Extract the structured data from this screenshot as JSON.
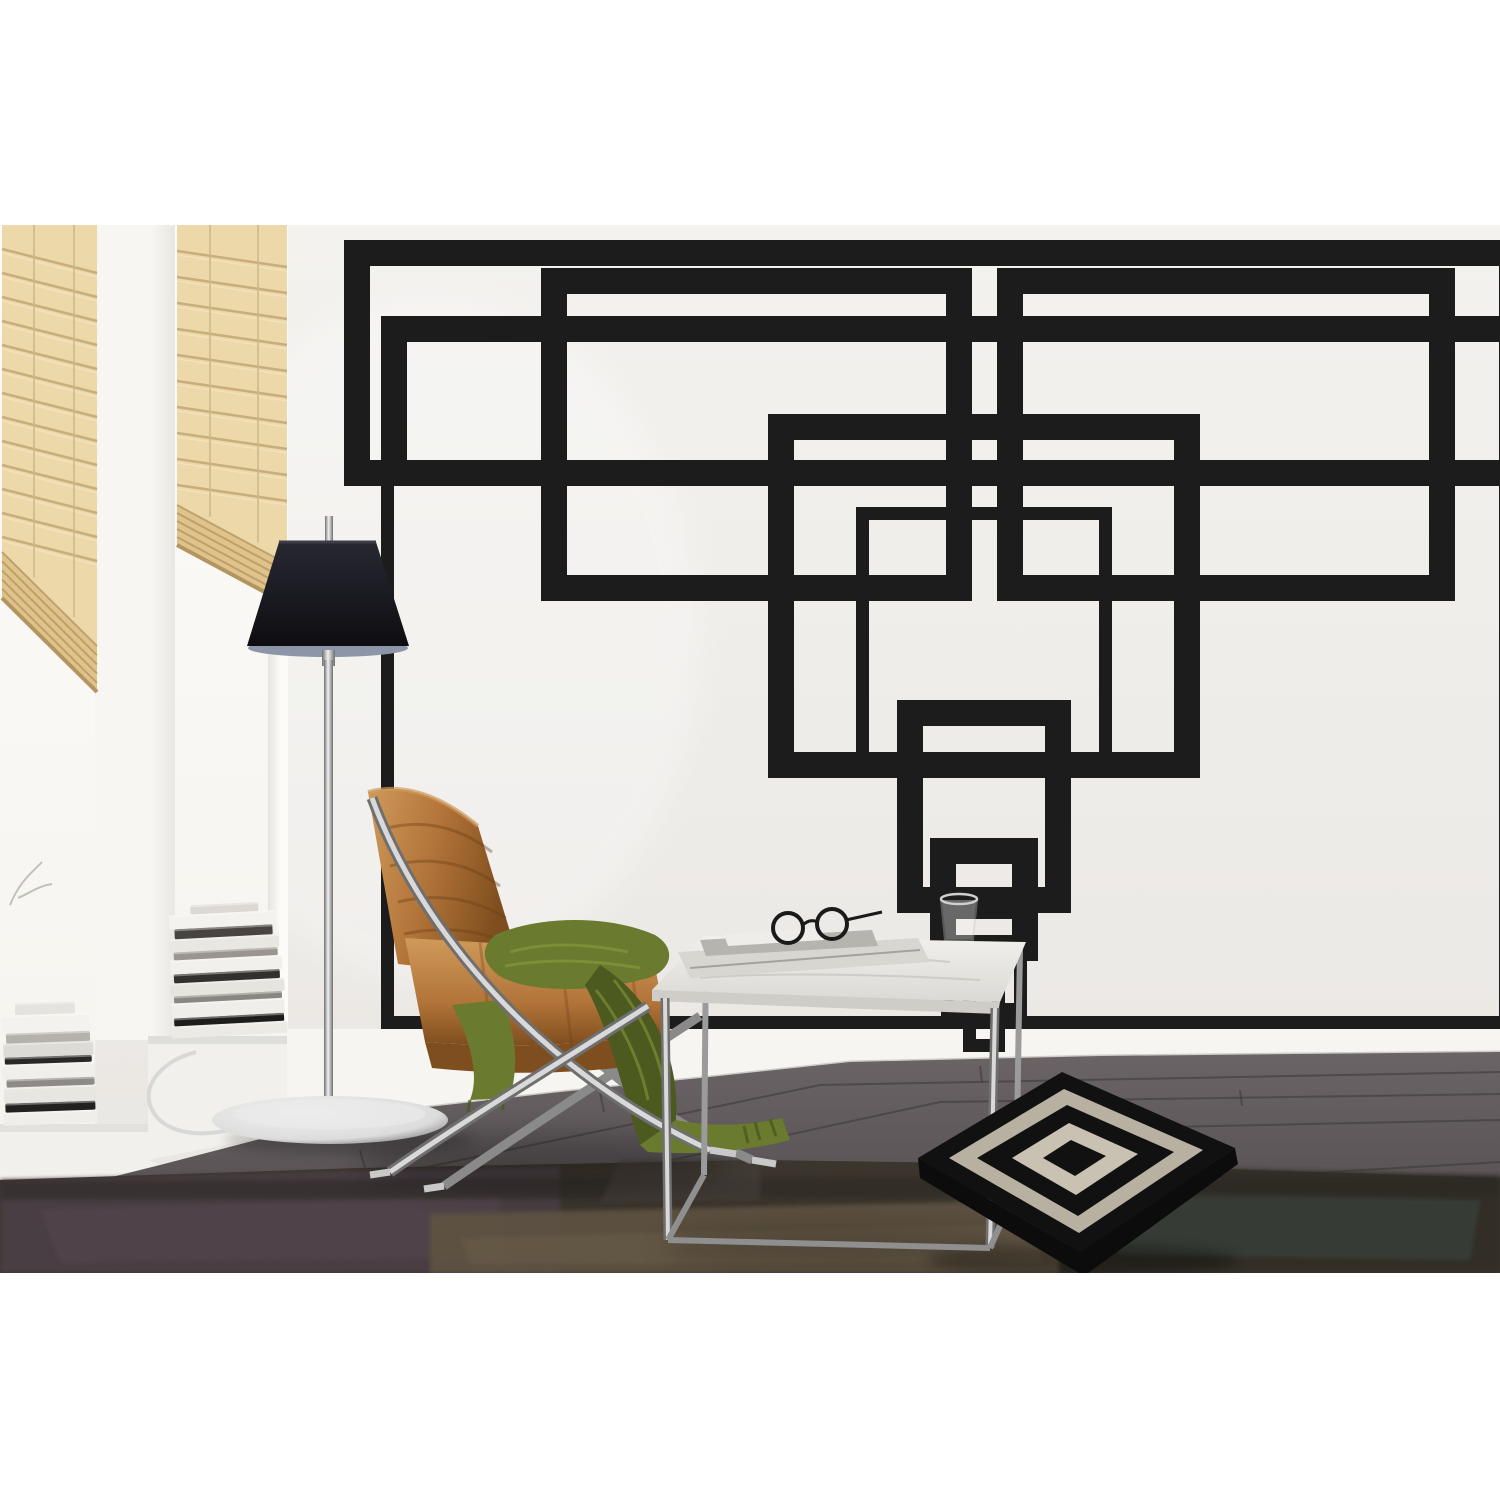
{
  "scene": {
    "kind": "interior product photo",
    "subject": "black geometric rectangle tape wall mural in a living room",
    "canvas": 1500,
    "photo_top": 225,
    "photo_bottom": 1273
  },
  "palette": {
    "white": "#ffffff",
    "wallTop": "#f3f2ef",
    "wallBot": "#e9e6e2",
    "tape": "#1c1c1c",
    "windowTop": "#fdfcfa",
    "windowBot": "#f6f4ef",
    "pierA": "#f8f6f3",
    "pierB": "#e9e7e2",
    "jambHi": "#fcfbf8",
    "jambShadow": "#e6e4df",
    "blindLight": "#ecd8a9",
    "blindMid": "#dfc38b",
    "blindDark": "#b2955f",
    "blindLine": "#c4a674",
    "cord": "#cdb98c",
    "baseboard": "#f6f5f2",
    "baseEdge": "#cfcdc8",
    "floorTop": "#6b6466",
    "floorBot": "#4e494b",
    "seam": "#3a3638",
    "rugBase": "#3b352d",
    "chromeHi": "#dcdcdc",
    "chromeLo": "#6f6f6f",
    "chromeCore": "#f2f2f2",
    "shadeTop": "#282832",
    "shadeBot": "#0d0d11",
    "diffuser": "#8d96a8",
    "leatherA": "#b27439",
    "leatherB": "#7f4e1e",
    "leatherHi": "#cf9a5a",
    "leatherSeam": "#6d3f16",
    "green": "#6a7a2e",
    "greenDark": "#4c5a1f",
    "greenHi": "#8ea23f",
    "marbleA": "#f2f0ec",
    "marbleB": "#dbd9d4",
    "paper": "#d8d6d1",
    "paperDark": "#b6b4af",
    "paperLight": "#eeede9",
    "pillowBlack": "#111111",
    "pillowIvoryA": "#b8b1a2",
    "pillowIvoryB": "#c9c2b2",
    "shadow": "#000000"
  },
  "mural": {
    "tape_width": 13,
    "color": "#1c1c1c",
    "rects": [
      [
        344,
        240,
        1512,
        486
      ],
      [
        357,
        253,
        1512,
        473
      ],
      [
        541,
        268,
        972,
        601
      ],
      [
        554,
        281,
        959,
        588
      ],
      [
        997,
        268,
        1455,
        601
      ],
      [
        1010,
        281,
        1442,
        588
      ],
      [
        381,
        316,
        1512,
        1029
      ],
      [
        394,
        329,
        1512,
        473
      ],
      [
        768,
        414,
        1200,
        778
      ],
      [
        781,
        427,
        1187,
        765
      ],
      [
        856,
        507,
        1112,
        765
      ],
      [
        897,
        700,
        1071,
        913
      ],
      [
        910,
        713,
        1058,
        900
      ],
      [
        930,
        838,
        1038,
        961
      ],
      [
        943,
        851,
        1025,
        948
      ],
      [
        941,
        906,
        1027,
        1016
      ],
      [
        963,
        955,
        1005,
        1052
      ]
    ]
  },
  "blinds": [
    {
      "x1": 2,
      "x2": 97,
      "top": 225,
      "y_bottom_left": 598,
      "y_bottom_right": 692,
      "slat_step": 24,
      "slat_tilt": 24,
      "bunch": 46,
      "cords": [
        34,
        74
      ]
    },
    {
      "x1": 177,
      "x2": 287,
      "top": 225,
      "y_bottom_left": 545,
      "y_bottom_right": 604,
      "slat_step": 26,
      "slat_tilt": 16,
      "bunch": 40,
      "cords": [
        210,
        258
      ]
    }
  ],
  "books": {
    "left": {
      "x": 4,
      "base_y": 1124,
      "tilt": -2,
      "items": [
        [
          94,
          13,
          "#efeeea",
          0
        ],
        [
          90,
          9,
          "#23211f",
          2
        ],
        [
          92,
          16,
          "#e8e6e1",
          1
        ],
        [
          88,
          8,
          "#8e8b86",
          4
        ],
        [
          93,
          15,
          "#f1efeb",
          0
        ],
        [
          87,
          7,
          "#2a2826",
          3
        ],
        [
          90,
          14,
          "#dddbd6",
          2
        ],
        [
          84,
          10,
          "#b5b2ac",
          5
        ],
        [
          88,
          18,
          "#f4f2ee",
          1
        ],
        [
          60,
          12,
          "#e5e3de",
          15
        ]
      ]
    },
    "right": {
      "x": 172,
      "base_y": 1036,
      "tilt": -3,
      "items": [
        [
          116,
          12,
          "#eceae5",
          0
        ],
        [
          110,
          8,
          "#1e1d1b",
          3
        ],
        [
          113,
          15,
          "#f0eeea",
          1
        ],
        [
          108,
          7,
          "#8a8781",
          4
        ],
        [
          114,
          13,
          "#e6e4df",
          1
        ],
        [
          106,
          9,
          "#33312e",
          5
        ],
        [
          112,
          14,
          "#f2f0ec",
          2
        ],
        [
          104,
          8,
          "#9a968f",
          6
        ],
        [
          110,
          13,
          "#e9e7e2",
          2
        ],
        [
          98,
          10,
          "#474441",
          8
        ],
        [
          106,
          14,
          "#f4f2ee",
          3
        ],
        [
          68,
          9,
          "#dcd9d4",
          25
        ]
      ]
    }
  },
  "floor": {
    "seams": [
      "M0,1256 L820,1085 L1500,1072",
      "M150,1273 L940,1102 L1500,1094",
      "M520,1273 L1120,1128 L1500,1120",
      "M960,1273 L1330,1172 L1500,1162",
      "M600,1092 L604,1112",
      "M980,1066 L982,1082",
      "M1240,1090 L1242,1106",
      "M360,1150 L366,1172"
    ]
  },
  "rug": {
    "outline": "0,1180 360,1168 760,1160 1100,1165 1500,1178 1500,1273 0,1273",
    "patches": [
      {
        "pts": "0,1180 560,1166 560,1273 0,1273",
        "c": "#4b4146",
        "o": 0.85
      },
      {
        "pts": "40,1210 500,1196 500,1258 60,1262",
        "c": "#564a50",
        "o": 0.5
      },
      {
        "pts": "430,1214 1060,1200 1060,1273 430,1273",
        "c": "#5f5342",
        "o": 0.9
      },
      {
        "pts": "460,1238 1040,1224 1040,1262 470,1264",
        "c": "#6b5d49",
        "o": 0.5
      },
      {
        "pts": "1060,1164 1500,1176 1500,1273 1060,1273",
        "c": "#322e27",
        "o": 0.9
      },
      {
        "pts": "1100,1190 1480,1200 1470,1260 1120,1255",
        "c": "#3c4f48",
        "o": 0.45
      },
      {
        "pts": "0,1180 1500,1176 1500,1196 0,1200",
        "c": "#2c2823",
        "o": 0.5
      },
      {
        "pts": "620,1160 760,1158 760,1200 600,1202",
        "c": "#46403a",
        "o": 0.6
      }
    ]
  }
}
